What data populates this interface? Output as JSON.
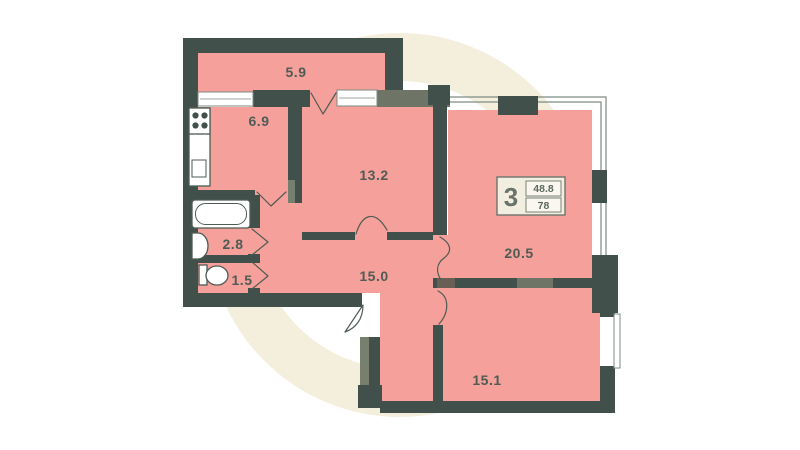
{
  "plan_type": "apartment-floor-plan",
  "rooms": [
    {
      "name": "balcony",
      "area": "5.9"
    },
    {
      "name": "kitchen",
      "area": "6.9"
    },
    {
      "name": "bedroom-1",
      "area": "13.2"
    },
    {
      "name": "bathroom",
      "area": "2.8"
    },
    {
      "name": "toilet",
      "area": "1.5"
    },
    {
      "name": "hallway",
      "area": "15.0"
    },
    {
      "name": "living-room",
      "area": "20.5"
    },
    {
      "name": "bedroom-2",
      "area": "15.1"
    }
  ],
  "badge": {
    "rooms_count": "3",
    "value_top": "48.8",
    "value_bottom": "78"
  },
  "fixtures": [
    "stove",
    "kitchen-sink",
    "bathtub",
    "washbasin",
    "toilet"
  ],
  "colors": {
    "room_fill": "#f5a09a",
    "wall": "#42504b",
    "wall_olive": "#6e7566",
    "wall_olive2": "#77806f",
    "wall_brown": "#6a5f55",
    "label": "#4f5b55",
    "watermark": "#f4eedd",
    "window_line": "#7d8a82",
    "badge_bg": "#f2efe1",
    "badge_cell": "#faf8ee",
    "badge_border": "#6b766d"
  }
}
